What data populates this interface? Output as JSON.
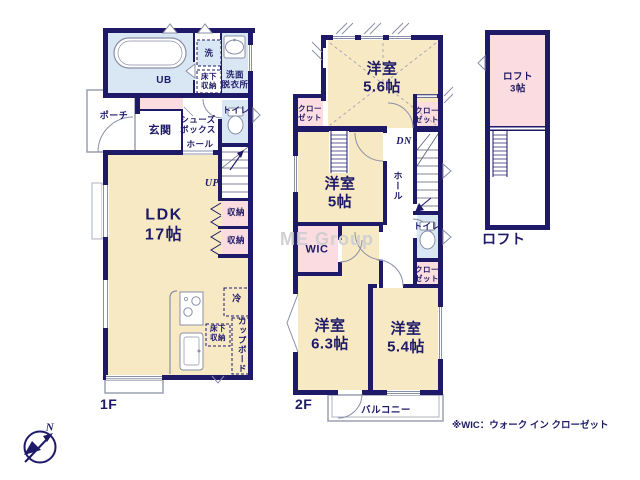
{
  "colors": {
    "wall": "#1e1a68",
    "room_beige": "#f6e9c3",
    "room_pink": "#fbdce0",
    "room_blue": "#d8e7f3",
    "outline_gray": "#9aa0b0",
    "text_navy": "#1e1a68",
    "watermark_gray": "#d0d0d0"
  },
  "watermark": "ME Group",
  "note": "※WIC：ウォーク イン クローゼット",
  "compass": {
    "north": "N"
  },
  "floor1": {
    "label": "1F",
    "porch": "ポーチ",
    "entrance": "玄関",
    "shoe_box": "シューズ\nボックス",
    "hall": "ホール",
    "unit_bath": "UB",
    "washer": "洗",
    "underfloor_storage": "床下\n収納",
    "washroom": "洗面\n脱衣所",
    "toilet": "トイレ",
    "stairs": "UP",
    "storage_a": "収納",
    "storage_b": "収納",
    "ldk": "LDK\n17帖",
    "fridge": "冷",
    "kitchen_underfloor_storage": "床下\n収納",
    "cupboard": "カップボード"
  },
  "floor2": {
    "label": "2F",
    "bedroom_56": "洋室\n5.6帖",
    "closet_tl": "クロー\nゼット",
    "closet_tr": "クロー\nゼット",
    "stairs": "DN",
    "hall": "ホール",
    "bedroom_5": "洋室\n5帖",
    "toilet": "トイレ",
    "wic": "WIC",
    "closet_mid": "クロー\nゼット",
    "bedroom_63": "洋室\n6.3帖",
    "bedroom_54": "洋室\n5.4帖",
    "balcony": "バルコニー"
  },
  "loft": {
    "label": "ロフト",
    "room": "ロフト\n3帖"
  }
}
